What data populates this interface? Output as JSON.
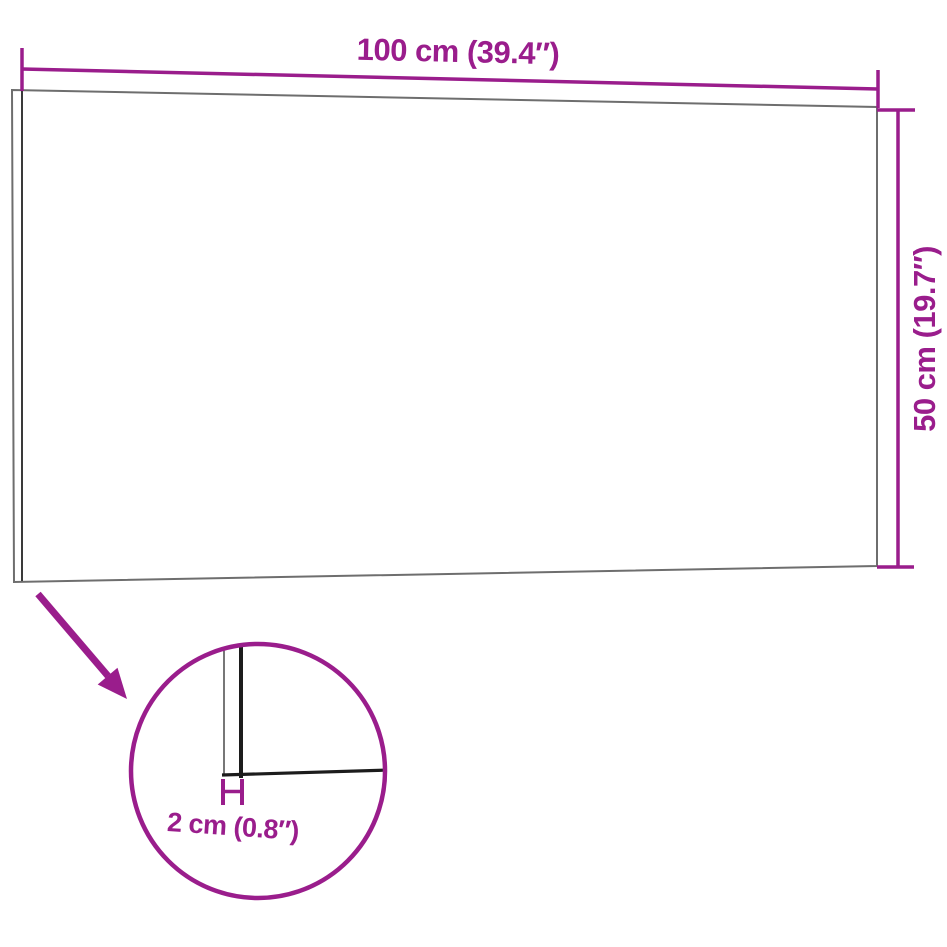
{
  "diagram": {
    "subject": "wall-panel-dimension-diagram",
    "width_label": "100 cm (39.4″)",
    "height_label": "50 cm (19.7″)",
    "thickness_label": "2 cm (0.8″)",
    "colors": {
      "accent": "#9a1d8c",
      "panel_outline": "#6e6e6e",
      "panel_inner_edge": "#3a3a3a",
      "detail_line": "#1c1c1c",
      "detail_thin_line": "#555555",
      "background": "#ffffff"
    }
  }
}
